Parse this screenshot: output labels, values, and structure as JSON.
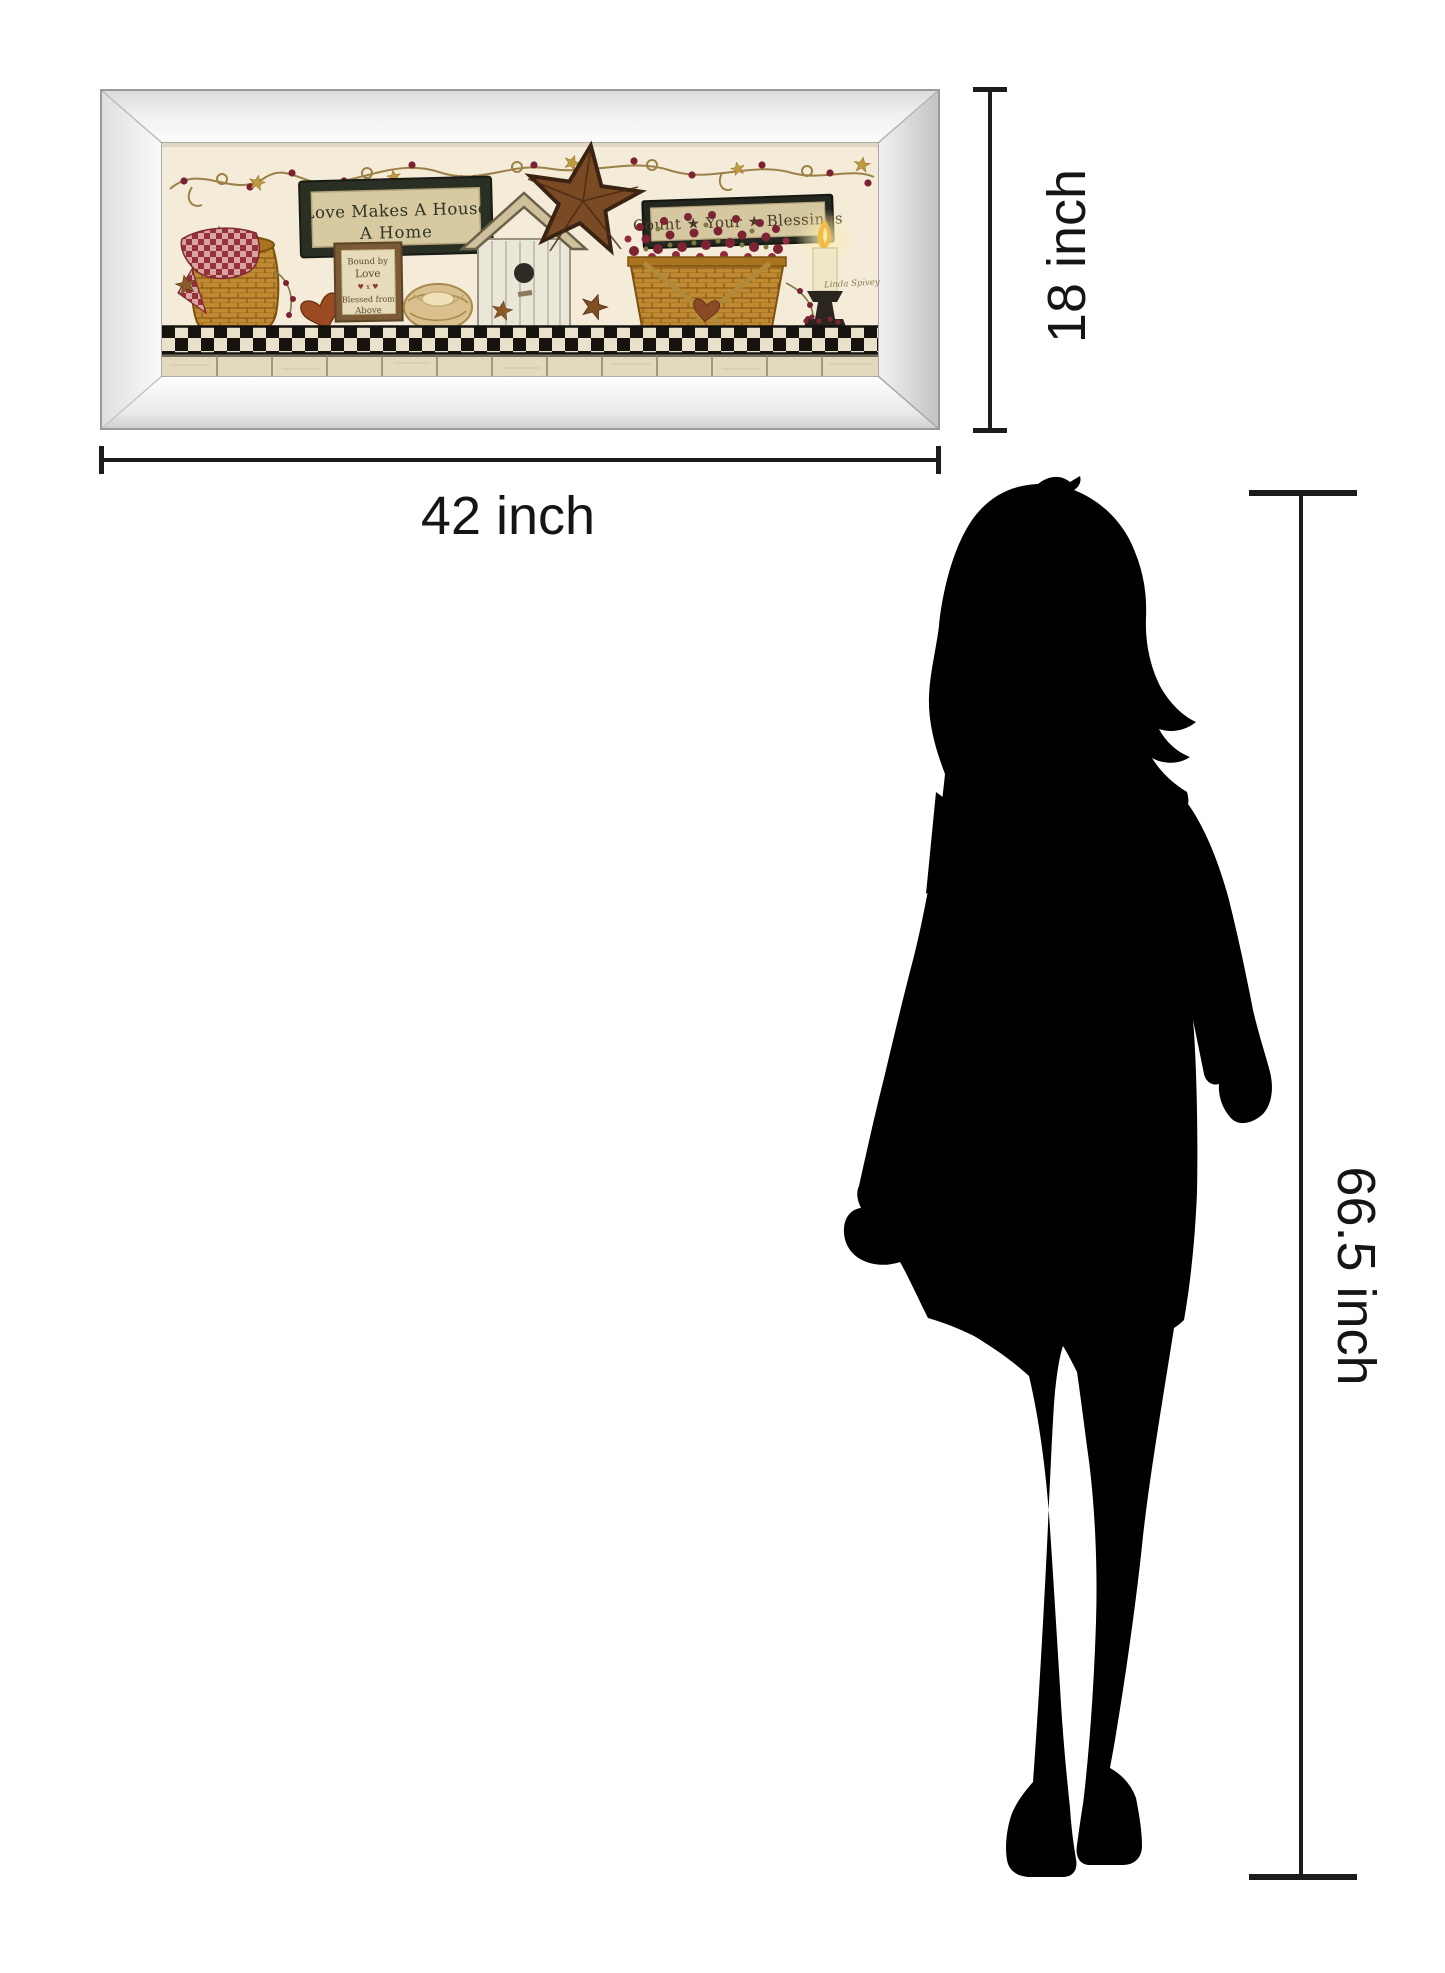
{
  "page": {
    "background_color": "#ffffff"
  },
  "artwork": {
    "description": "mirror-framed country shelf still-life print",
    "art_background_color": "#f4ecd9",
    "signs": {
      "love_sign": {
        "line1": "Love Makes A House",
        "line2": "A Home"
      },
      "bound_sign": {
        "line1": "Bound by",
        "line2": "Love",
        "line3": "♥ x ♥",
        "line4": "Blessed from",
        "line5": "Above"
      },
      "blessings_sign": {
        "text": "Count ★ Your ★ Blessings"
      }
    },
    "signature": "Linda Spivey"
  },
  "dimension_annotations": {
    "line_color": "#1c1c1c",
    "frame_width": {
      "label": "42 inch"
    },
    "frame_height": {
      "label": "18 inch"
    },
    "person_height": {
      "label": "66.5 inch"
    }
  },
  "silhouette": {
    "description": "standing woman silhouette",
    "color": "#000000"
  }
}
